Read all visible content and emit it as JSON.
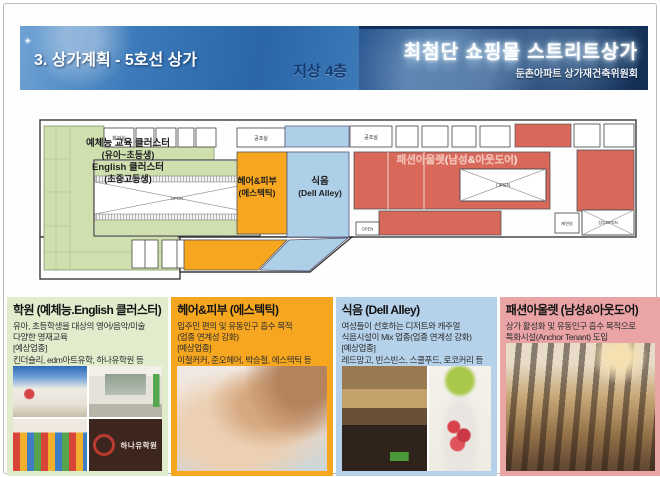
{
  "header": {
    "left_title": "3. 상가계획 - 5호선 상가",
    "floor_label": "지상 4층",
    "right_title": "최첨단 쇼핑몰 스트리트상가",
    "right_subtitle": "둔촌아파트 상가재건축위원회"
  },
  "plan": {
    "zones": {
      "academy": {
        "lines": [
          "예체능 교육 클러스터",
          "(유아~초등생)",
          "English 클러스터",
          "(초중고등생)"
        ],
        "color": "#cfe0ae"
      },
      "hair": {
        "lines": [
          "헤어&피부",
          "(에스텍틱)"
        ],
        "color": "#f6a71f"
      },
      "food": {
        "lines": [
          "식음",
          "(Dell Alley)"
        ],
        "color": "#aecfe8"
      },
      "fashion": {
        "label": "패션아울렛(남성&아웃도어)",
        "color": "#d8685a"
      }
    },
    "rooms": {
      "meeting": "회의실",
      "hvac_a": "공조실",
      "hvac_b": "공조실",
      "smoke": "제연실",
      "upper_open": "상부OPEN",
      "open_center": "OPEN",
      "open_right": "OPEN",
      "open_bar": "OPEN"
    }
  },
  "panels": [
    {
      "title": "학원 (예체능.English 클러스터)",
      "lines": [
        "유아, 초등학생을 대상의 영어/음악/미술",
        "다양한 영재교육",
        "[예상업종]",
        "킨더슐리, edm아트유학, 하나유학원 등"
      ],
      "bg": "#e1eccd"
    },
    {
      "title": "헤어&피부 (에스텍틱)",
      "lines": [
        "입주민 편의 및 유동인구 흡수 목적",
        "(업종 연계성 강화)",
        "[예상업종]",
        "이철커커, 준오헤어, 박승철, 에스텍틱 등"
      ],
      "bg": "#f6a71f"
    },
    {
      "title": "식음 (Dell Alley)",
      "lines": [
        "여성들이 선호하는 디저트와 캐주얼",
        "식음시설이 Mix 업종(업종 연계성 강화)",
        "[예상업종]",
        "레드망고, 빈스빈스, 스쿨푸드, 로코커리 등"
      ],
      "bg": "#b5d2ea"
    },
    {
      "title": "패션아울렛 (남성&아웃도어)",
      "lines": [
        "상가 활성화 및 유동인구 흡수 목적으로",
        "특화시설(Anchor Tenant) 도입"
      ],
      "bg": "#eba4a6"
    }
  ],
  "photos": {
    "hana_sign": "하나유학원"
  },
  "colors": {
    "header_blue": "#2a66a8",
    "header_navy": "#142f55",
    "plan_green": "#cfe0ae",
    "plan_orange": "#f6a71f",
    "plan_blue": "#aecfe8",
    "plan_red": "#d8685a"
  }
}
